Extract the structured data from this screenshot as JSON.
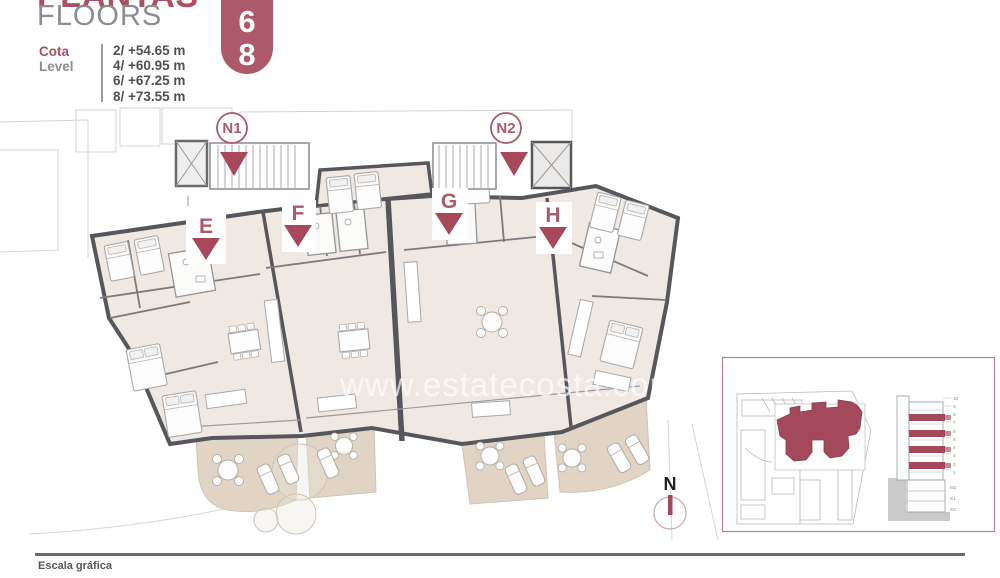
{
  "header": {
    "title_primary": "PLANTAS",
    "title_secondary": "FLOORS",
    "cota_label_es": "Cota",
    "cota_label_en": "Level",
    "levels": [
      "2/ +54.65 m",
      "4/ +60.95 m",
      "6/ +67.25 m",
      "8/ +73.55 m"
    ],
    "badge_floors": [
      "4",
      "6",
      "8"
    ]
  },
  "plan": {
    "node_labels": [
      "N1",
      "N2"
    ],
    "unit_labels": [
      "E",
      "F",
      "G",
      "H"
    ],
    "watermark": "www.estatecosta.com"
  },
  "inset": {
    "elevation": {
      "floor_labels": [
        "10",
        "9",
        "8",
        "7",
        "6",
        "5",
        "4",
        "3",
        "2",
        "1",
        "M2",
        "S1",
        "S2"
      ],
      "highlighted_floors": [
        8,
        6,
        4,
        2
      ]
    }
  },
  "compass": {
    "label": "N"
  },
  "footer": {
    "scale_label": "Escala gráfica"
  },
  "colors": {
    "accent": "#ac5a6b",
    "marker_red": "#a8495b",
    "wall": "#56575c",
    "room_fill": "#f0e8e2",
    "terrace_fill": "#e1d4c4",
    "title_gray": "#8b8e90"
  }
}
